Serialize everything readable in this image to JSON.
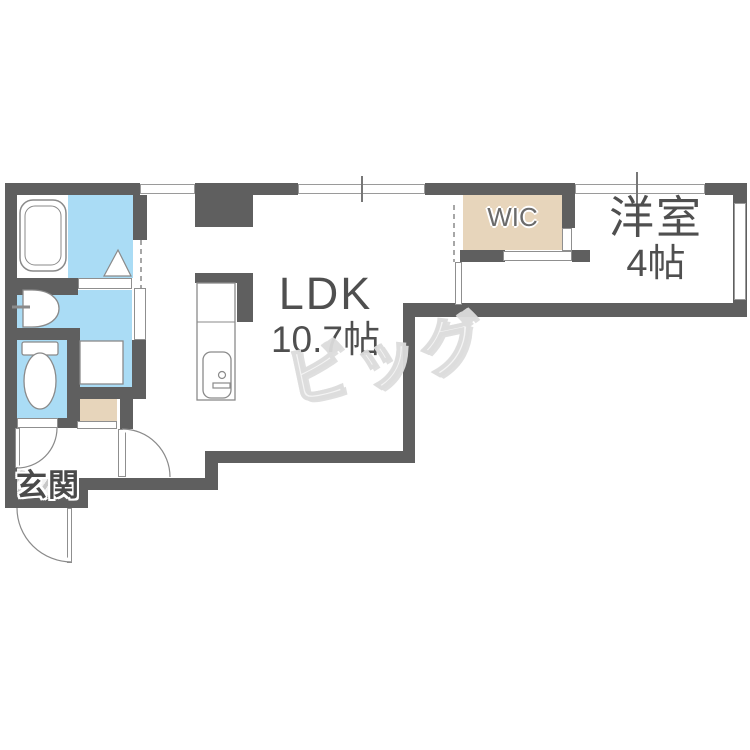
{
  "plan": {
    "rooms": {
      "ldk": {
        "label": "LDK",
        "size": "10.7帖"
      },
      "western_room": {
        "label": "洋室",
        "size": "4帖"
      },
      "wic": {
        "label": "WIC"
      },
      "entrance": {
        "label": "玄関"
      }
    },
    "watermark": "ビッグ",
    "colors": {
      "wall": "#5f5f5f",
      "water": "#aadcf5",
      "closet": "#e7d5bb",
      "line": "#8a8a8a",
      "text": "#4f4f4f"
    }
  }
}
